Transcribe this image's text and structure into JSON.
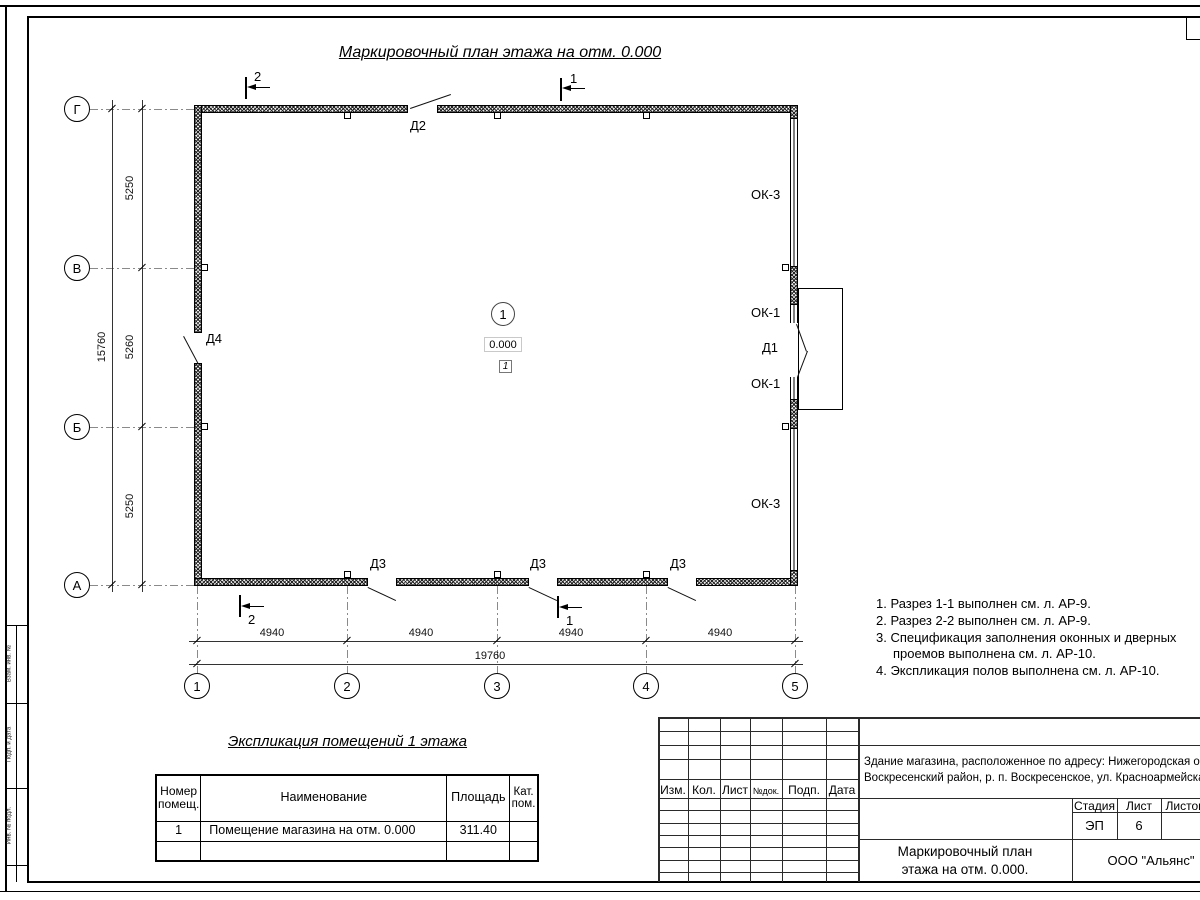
{
  "drawing_title": "Маркировочный план этажа на отм. 0.000",
  "plan": {
    "axes_vertical": [
      "Г",
      "В",
      "Б",
      "А"
    ],
    "axes_horizontal": [
      "1",
      "2",
      "3",
      "4",
      "5"
    ],
    "dims_left": [
      "5250",
      "5260",
      "5250"
    ],
    "dim_left_total": "15760",
    "dims_bottom": [
      "4940",
      "4940",
      "4940",
      "4940"
    ],
    "dim_bottom_total": "19760",
    "sections": {
      "one": "1",
      "two": "2"
    },
    "doors": {
      "d1": "Д1",
      "d2": "Д2",
      "d3": "Д3",
      "d4": "Д4"
    },
    "windows": {
      "ok1": "ОК-1",
      "ok3": "ОК-3"
    },
    "room": {
      "number": "1",
      "elevation": "0.000",
      "floor_type": "1"
    }
  },
  "notes": {
    "lines": [
      "1. Разрез 1-1 выполнен см. л. АР-9.",
      "2. Разрез 2-2 выполнен см. л. АР-9.",
      "3. Спецификация заполнения оконных и дверных",
      "проемов выполнена см. л. АР-10.",
      "4. Экспликация полов выполнена см. л. АР-10."
    ]
  },
  "explication": {
    "title": "Экспликация помещений 1 этажа",
    "headers": {
      "num": "Номер помещ.",
      "name": "Наименование",
      "area": "Площадь",
      "cat": "Кат. пом."
    },
    "row": {
      "num": "1",
      "name": "Помещение магазина на отм. 0.000",
      "area": "311.40"
    }
  },
  "titleblock": {
    "rev": {
      "izm": "Изм.",
      "kol": "Кол.",
      "list": "Лист",
      "ndok": "№док.",
      "podp": "Подп.",
      "data": "Дата"
    },
    "object_line1": "Здание магазина, расположенное по адресу: Нижегородская область,",
    "object_line2": "Воскресенский район, р. п. Воскресенское, ул. Красноармейская, д. 1",
    "stage_label": "Стадия",
    "sheet_label": "Лист",
    "sheets_label": "Листов",
    "stage_value": "ЭП",
    "sheet_value": "6",
    "doc_line1": "Маркировочный план",
    "doc_line2": "этажа на отм. 0.000.",
    "company": "ООО \"Альянс\""
  },
  "side_strip": {
    "s1": "Взам. инв. №",
    "s2": "Подп. и дата",
    "s3": "Инв. № подл."
  }
}
